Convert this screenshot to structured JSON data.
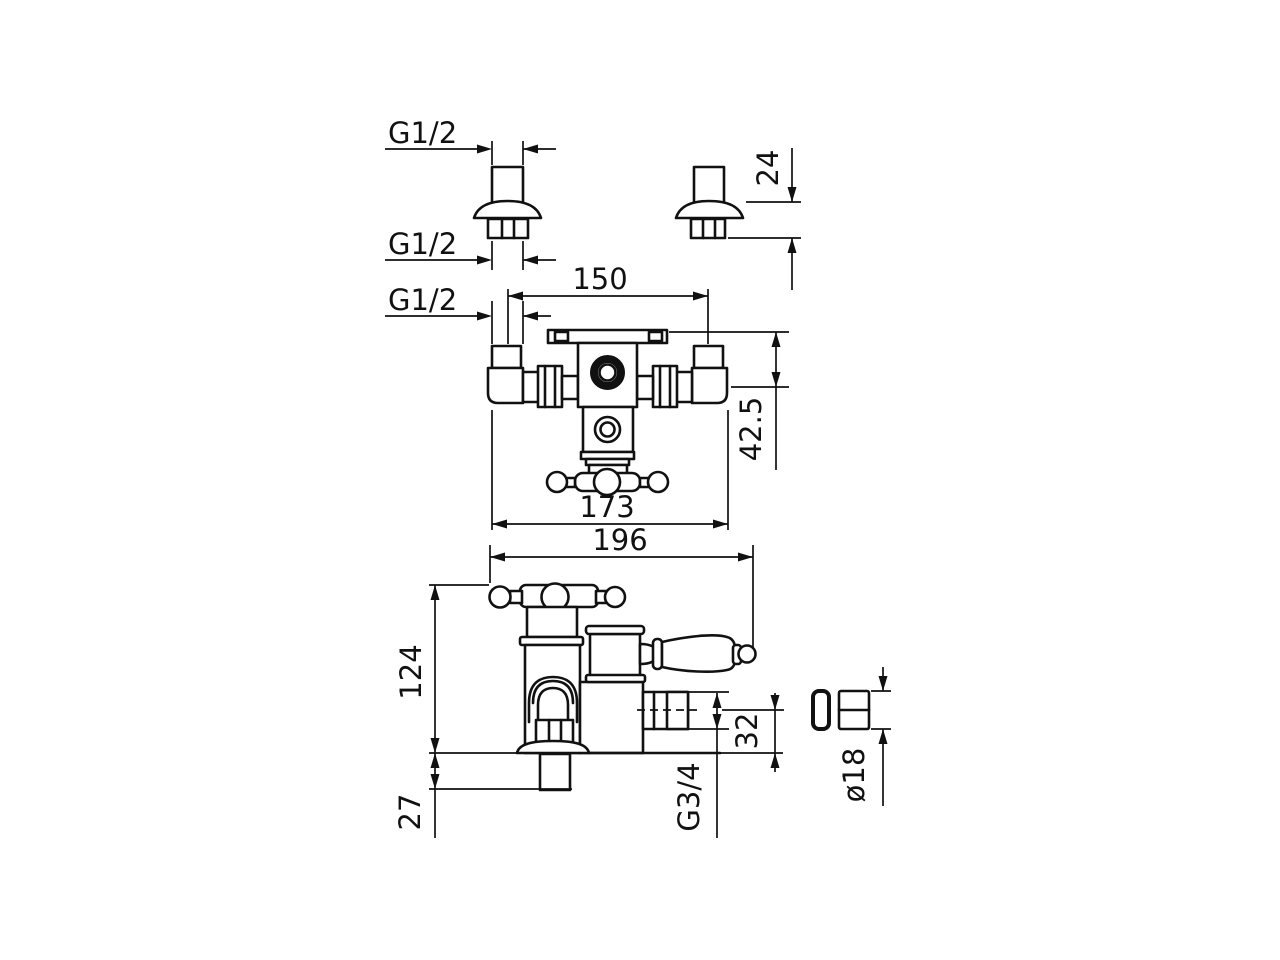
{
  "page": {
    "background": "#ffffff",
    "line_color": "#111111"
  },
  "drawing": {
    "kind": "faucet-mixer-technical-drawing",
    "dimensions": {
      "inlet_thread_top": {
        "label": "G1/2"
      },
      "inlet_thread_nut": {
        "label": "G1/2"
      },
      "inlet_thread_front": {
        "label": "G1/2"
      },
      "union_height": {
        "label": "24"
      },
      "inlet_spacing": {
        "label": "150"
      },
      "body_depth": {
        "label": "42.5"
      },
      "body_width": {
        "label": "173"
      },
      "overall_width": {
        "label": "196"
      },
      "overall_height": {
        "label": "124"
      },
      "tail_length": {
        "label": "27"
      },
      "outlet_offset": {
        "label": "32"
      },
      "outlet_thread": {
        "label": "G3/4"
      },
      "nut_diameter": {
        "label": "ø18"
      }
    }
  }
}
